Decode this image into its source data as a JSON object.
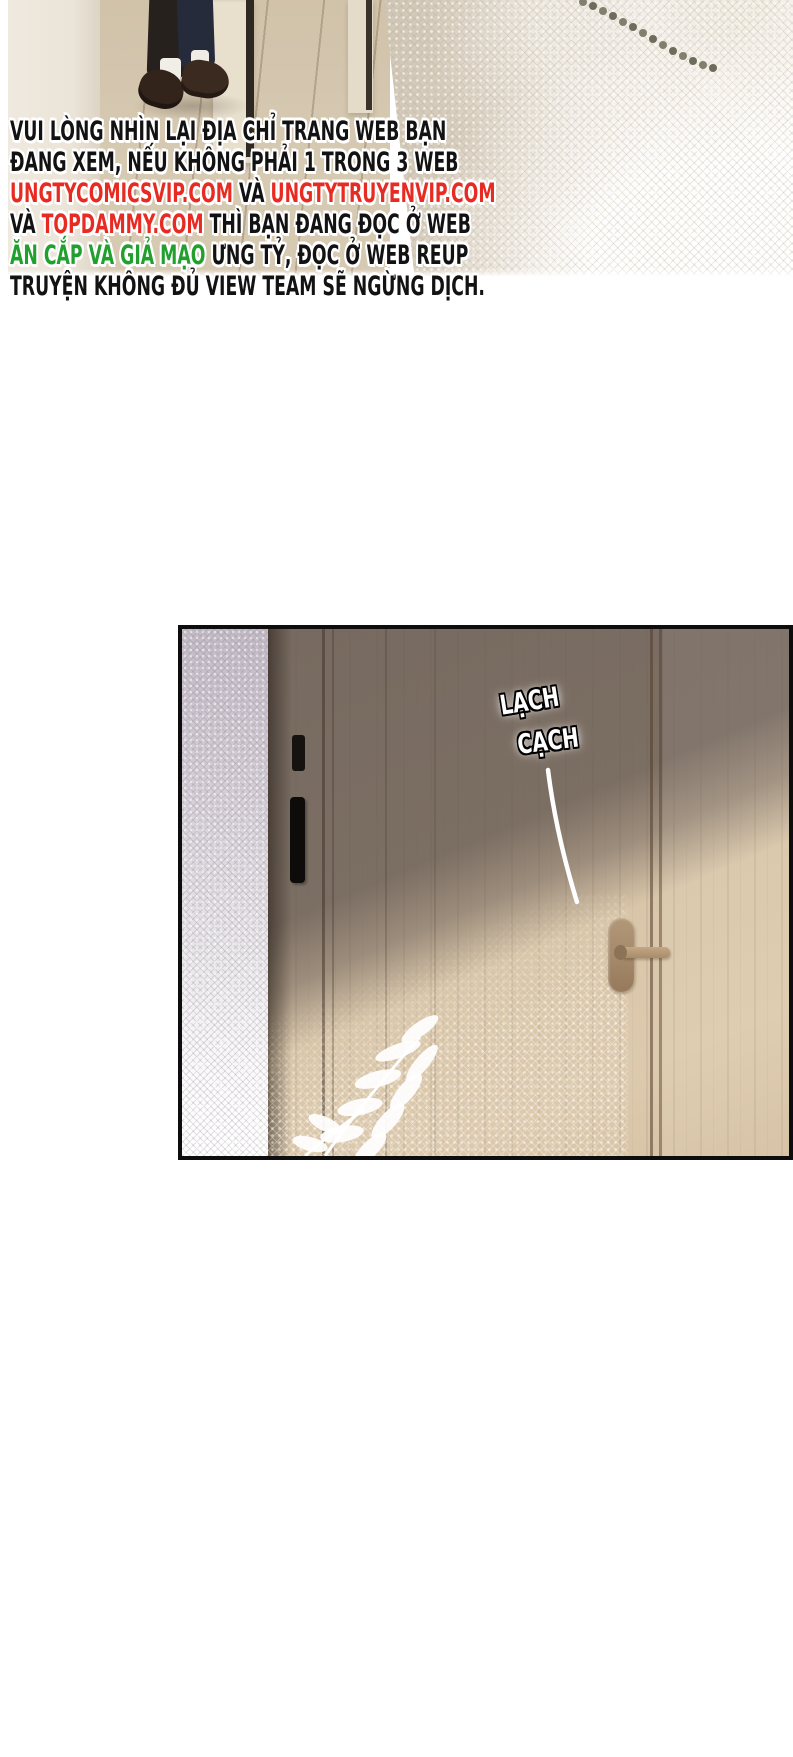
{
  "colors": {
    "red": "#e82b22",
    "green": "#21a02e",
    "black": "#121212",
    "panel_border": "#0d0d0d"
  },
  "warning": {
    "lines": [
      {
        "segments": [
          {
            "text": "VUI LÒNG NHÌN LẠI ĐỊA CHỈ TRANG WEB BẠN",
            "color": "black"
          }
        ]
      },
      {
        "segments": [
          {
            "text": "ĐANG XEM, NẾU KHÔNG PHẢI 1 TRONG 3 WEB",
            "color": "black"
          }
        ]
      },
      {
        "segments": [
          {
            "text": "UNGTYCOMICSVIP.COM",
            "color": "red"
          },
          {
            "text": " VÀ ",
            "color": "black"
          },
          {
            "text": "UNGTYTRUYENVIP.COM",
            "color": "red"
          }
        ]
      },
      {
        "segments": [
          {
            "text": "VÀ ",
            "color": "black"
          },
          {
            "text": "TOPDAMMY.COM",
            "color": "red"
          },
          {
            "text": " THÌ BẠN ĐANG ĐỌC Ở WEB",
            "color": "black"
          }
        ]
      },
      {
        "segments": [
          {
            "text": "ĂN CẮP VÀ GIẢ MẠO",
            "color": "green"
          },
          {
            "text": " ƯNG TỶ, ĐỌC Ở WEB REUP",
            "color": "black"
          }
        ]
      },
      {
        "segments": [
          {
            "text": "TRUYỆN KHÔNG ĐỦ VIEW TEAM SẼ NGỪNG DỊCH.",
            "color": "black"
          }
        ]
      }
    ]
  },
  "panel1": {
    "alt": "feet of a person in dark trousers and brown loafers standing on a wooden floor by a door, lace curtain on the right"
  },
  "panel2": {
    "alt": "wooden door with diagonal light, lace curtain at left, white leaf decals",
    "sfx_word1": "LẠCH",
    "sfx_word2": "CẠCH"
  }
}
